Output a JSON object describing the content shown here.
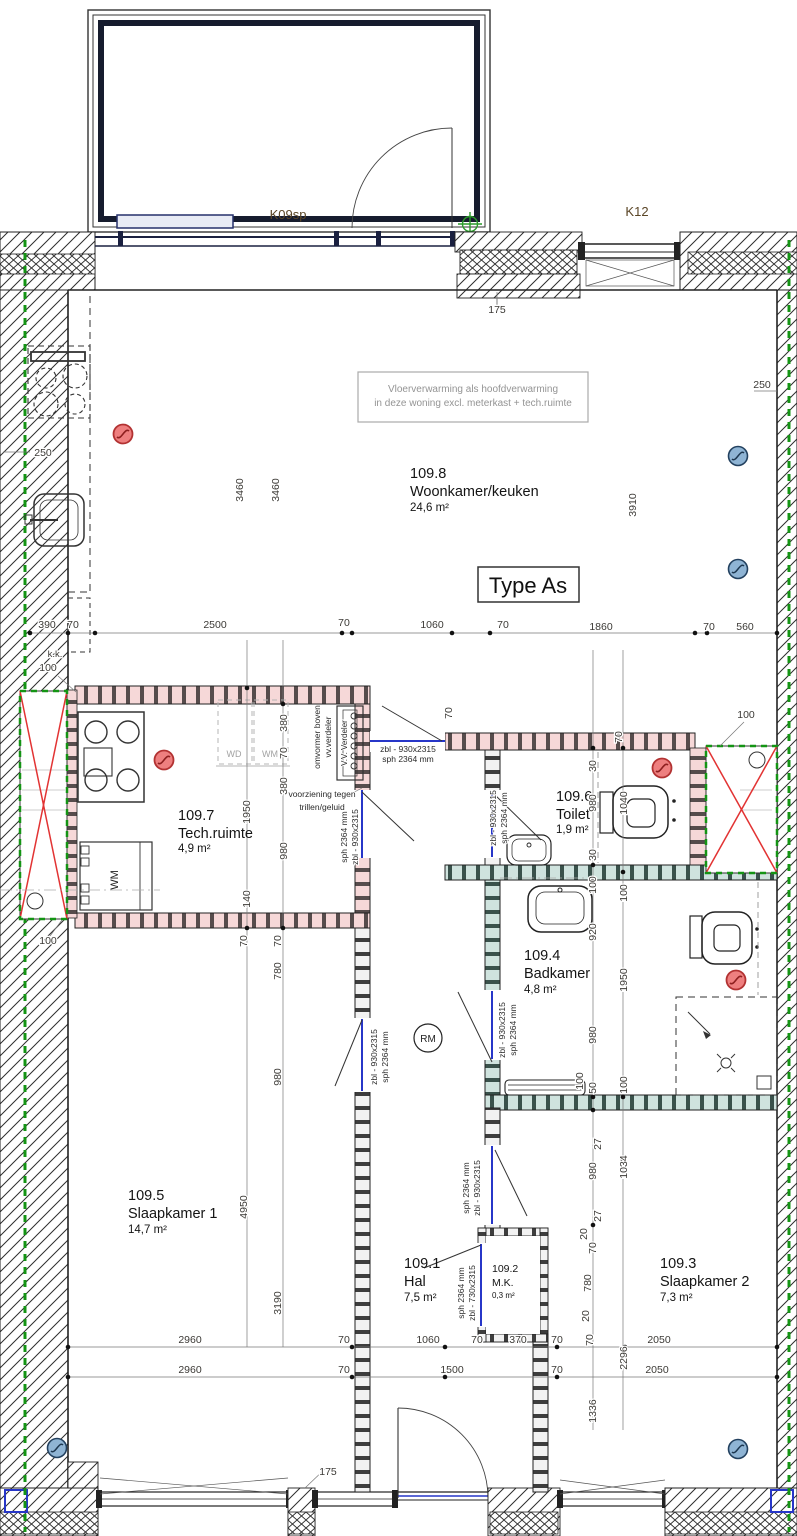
{
  "title": "Type As",
  "note": {
    "line1": "Vloerverwarming als hoofdverwarming",
    "line2": "in deze woning excl. meterkast + tech.ruimte"
  },
  "labels": {
    "k09sp": "K09sp",
    "k12": "K12",
    "rm": "RM",
    "wd": "WD",
    "wm": "WM",
    "wm_unit": "WM",
    "verdeler": "V.V. Verdeler",
    "omvormer1": "omvormer boven",
    "omvormer2": "vv.verdeler",
    "voorziening1": "voorziening tegen",
    "voorziening2": "trillen/geluid",
    "kk": "k.k."
  },
  "rooms": [
    {
      "number": "109.8",
      "name": "Woonkamer/keuken",
      "area": "24,6 m²"
    },
    {
      "number": "109.7",
      "name": "Tech.ruimte",
      "area": "4,9 m²"
    },
    {
      "number": "109.6",
      "name": "Toilet",
      "area": "1,9 m²"
    },
    {
      "number": "109.4",
      "name": "Badkamer",
      "area": "4,8 m²"
    },
    {
      "number": "109.5",
      "name": "Slaapkamer 1",
      "area": "14,7 m²"
    },
    {
      "number": "109.1",
      "name": "Hal",
      "area": "7,5 m²"
    },
    {
      "number": "109.2",
      "name": "M.K.",
      "area": "0,3 m²"
    },
    {
      "number": "109.3",
      "name": "Slaapkamer 2",
      "area": "7,3 m²"
    }
  ],
  "specs": [
    "zbl - 930x2315",
    "sph 2364 mm",
    "zbl - 930x2315",
    "sph 2364 mm",
    "sph 2364 mm",
    "zbl - 930x2315",
    "zbl - 930x2315",
    "sph 2364 mm",
    "zbl - 930x2315",
    "sph 2364 mm",
    "sph 2364 mm",
    "zbl - 930x2315",
    "sph 2364 mm",
    "zbl - 730x2315"
  ],
  "dims": [
    "175",
    "250",
    "3910",
    "250",
    "3460",
    "3460",
    "390",
    "70",
    "2500",
    "70",
    "1060",
    "70",
    "1860",
    "70",
    "560",
    "100",
    "380",
    "70",
    "380",
    "1950",
    "980",
    "140",
    "70",
    "70",
    "780",
    "980",
    "4950",
    "3190",
    "100",
    "100",
    "70",
    "70",
    "30",
    "980",
    "1040",
    "30",
    "100",
    "100",
    "920",
    "1950",
    "980",
    "100",
    "50",
    "100",
    "27",
    "980",
    "1034",
    "27",
    "20",
    "70",
    "780",
    "20",
    "70",
    "2296",
    "1336",
    "2960",
    "70",
    "1060",
    "70",
    "370",
    "70",
    "2050",
    "2960",
    "70",
    "1500",
    "70",
    "2050",
    "175"
  ],
  "colors": {
    "detector_red": "#ee7f7f",
    "detector_blue": "#8fb4d4",
    "green_dashed": "#149414",
    "shaft_cross": "#e23333",
    "door_blue": "#2736c8",
    "wall_pink": "#f6d8d8",
    "wall_teal": "#cfe3de"
  }
}
